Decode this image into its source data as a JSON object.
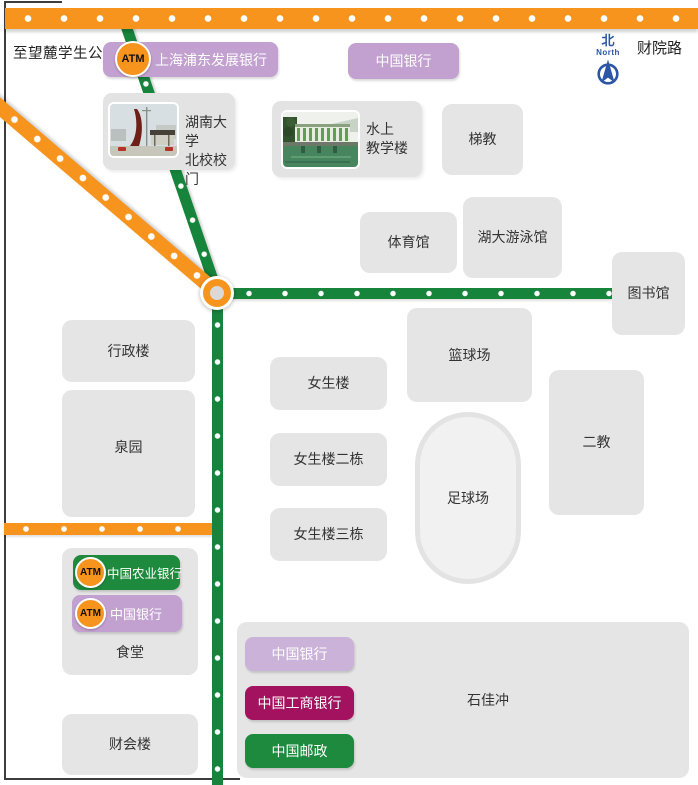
{
  "street_labels": {
    "wanglu": "至望麓学生公寓",
    "caiyuan_road": "财院路"
  },
  "compass": {
    "zh": "北",
    "en": "North"
  },
  "atm_badge": "ATM",
  "banks": {
    "spdb": "上海浦东发展银行",
    "boc_top": "中国银行",
    "abc": "中国农业银行",
    "boc_canteen": "中国银行",
    "boc_shijiachong": "中国银行",
    "icbc": "中国工商银行",
    "post": "中国邮政"
  },
  "buildings": {
    "gate": "湖南大学\n北校校门",
    "water_teaching": "水上\n教学楼",
    "tijiao": "梯教",
    "gym": "体育馆",
    "pool": "湖大游泳馆",
    "library": "图书馆",
    "admin": "行政楼",
    "quanyuan": "泉园",
    "girls1": "女生楼",
    "basketball": "篮球场",
    "girls2": "女生楼二栋",
    "girls3": "女生楼三栋",
    "football": "足球场",
    "erjiao": "二教",
    "canteen": "食堂",
    "caikuai": "财会楼",
    "shijiachong": "石佳冲"
  },
  "colors": {
    "road_orange": "#F7941E",
    "road_green": "#17843C",
    "bank_purple": "#C2A0D0",
    "bank_light_purple": "#CBB2D8",
    "bank_green": "#1E8A3D",
    "bank_magenta": "#A3125F",
    "building_gray": "#E5E5E5",
    "compass_blue": "#2B55A5"
  }
}
